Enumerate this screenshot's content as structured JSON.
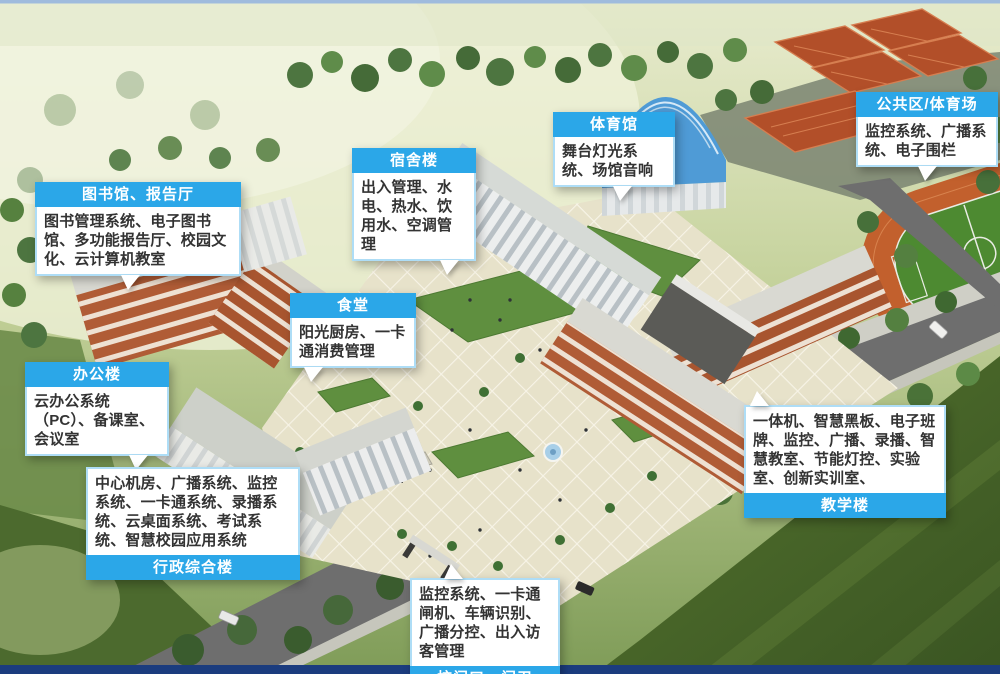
{
  "callouts": [
    {
      "id": "library-hall",
      "title": "图书馆、报告厅",
      "body": "图书管理系统、电子图书馆、多功能报告厅、校园文化、云计算机教室",
      "header_position": "top"
    },
    {
      "id": "dormitory",
      "title": "宿舍楼",
      "body": "出入管理、水电、热水、饮用水、空调管理",
      "header_position": "top"
    },
    {
      "id": "gymnasium",
      "title": "体育馆",
      "body": "舞台灯光系统、场馆音响",
      "header_position": "top"
    },
    {
      "id": "public-stadium",
      "title": "公共区/体育场",
      "body": "监控系统、广播系统、电子围栏",
      "header_position": "top"
    },
    {
      "id": "canteen",
      "title": "食堂",
      "body": "阳光厨房、一卡通消费管理",
      "header_position": "top"
    },
    {
      "id": "office",
      "title": "办公楼",
      "body": "云办公系统（PC）、备课室、会议室",
      "header_position": "top"
    },
    {
      "id": "admin-complex",
      "title": "行政综合楼",
      "body": "中心机房、广播系统、监控系统、一卡通系统、录播系统、云桌面系统、考试系统、智慧校园应用系统",
      "header_position": "bottom"
    },
    {
      "id": "teaching",
      "title": "教学楼",
      "body": "一体机、智慧黑板、电子班牌、监控、广播、录播、智慧教室、节能灯控、实验室、创新实训室、",
      "header_position": "bottom"
    },
    {
      "id": "gate",
      "title": "校门口、门卫",
      "body": "监控系统、一卡通闸机、车辆识别、广播分控、出入访客管理",
      "header_position": "bottom"
    }
  ],
  "colors": {
    "header_blue": "#2BA7E8",
    "header_text": "#FFFFFF",
    "body_bg": "#FFFFFF",
    "body_border": "#AEDDF6",
    "body_text": "#333333",
    "top_border_line": "#9FBBDD",
    "bottom_bar_navy": "#1B3C7E",
    "court_red": "#B24F29",
    "track_orange": "#C2602D",
    "field_green": "#4D8A31",
    "grass_dark": "#42622A",
    "road_gray": "#6E6E6E",
    "plaza_cream": "#E7E2CA",
    "building_brick": "#B05C36",
    "gym_roof_blue": "#4F9BD6"
  }
}
